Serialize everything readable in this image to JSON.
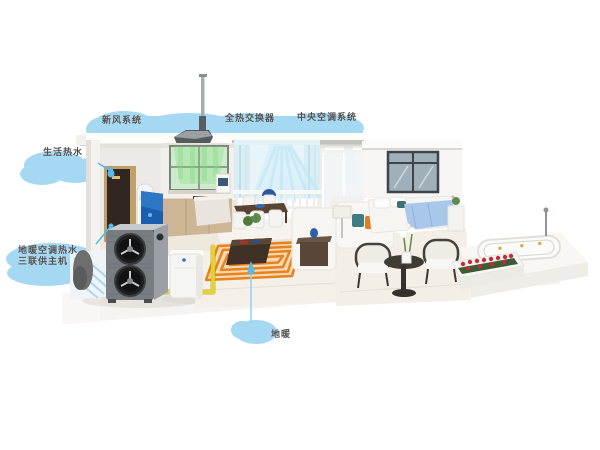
{
  "title": "家用空气源热泵三联供系统示意图",
  "labels": {
    "fresh_air": "新风系统",
    "heat_exchanger": "全热交换器",
    "central_ac": "中央空调系统",
    "hot_water": "生活热水",
    "heat_pump_line1": "地暖空调热水",
    "heat_pump_line2": "三联供主机",
    "floor_heating": "地暖"
  },
  "colors": {
    "callout_cloud": "#a5d8f2",
    "callout_pointer": "#55bae8",
    "label_text": "#4f4f4f",
    "fresh_air_flow": "#7ed87e",
    "ac_air_flow": "#aadcec",
    "floor_heating_coil": "#e8821c",
    "water_pipe_yellow": "#e7d32c",
    "heat_pump_body": "#787d82",
    "hot_water_cabinet_gold": "#bfa06a",
    "bed_blanket_blue": "#a9c8e9",
    "rose_red": "#c62b36"
  },
  "icons": {
    "cloud_callout": "cloud-blob",
    "pointer_drop": "teardrop",
    "pointer_dot": "dot"
  }
}
